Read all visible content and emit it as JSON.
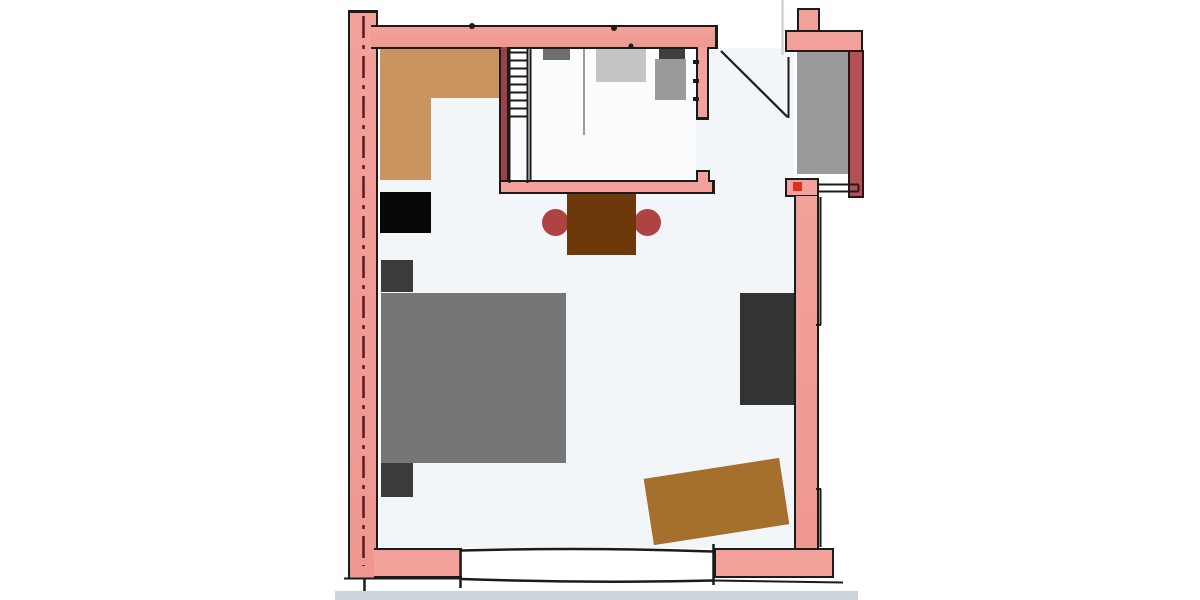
{
  "scene": {
    "kind": "scanned hand-drawn floor plan sketch with colored furniture overlay blocks",
    "no_text_visible": true
  },
  "palette": {
    "outline": "#1b1b1b",
    "dash_maroon": "#5b1a22",
    "wall_pink": "#f2a29b",
    "wall_pink_deep": "#ee978f",
    "wall_maroon": "#9c4149",
    "wall_deepred": "#b25156",
    "wall_deepred_edge": "#331116",
    "floor_main": "#f2f6f9",
    "floor_closet": "#fafcfe",
    "page_edge": "#ccd4da",
    "closet_tan": "#c9945f",
    "shelf_gray": "#6f6f6f",
    "shelf_light": "#c5c5c5",
    "shelf_dark": "#3f3f3f",
    "shelf_mid": "#9a9a9a",
    "divider_gray": "#9a9a9a",
    "black_unit": "#070707",
    "table_brown": "#6e390a",
    "chair_red": "#ad4343",
    "nightstand_gray": "#3b3b3b",
    "bed_gray": "#767676",
    "wardrobe_charcoal": "#333333",
    "rug_brown": "#a56f2d",
    "niche_gray": "#9a9a9a",
    "red_dot": "#e2301e",
    "fold_line": "#d9d3c7"
  },
  "items": [
    {
      "id": "closet-tan",
      "desc": "L-shaped tan wardrobe/closet block, top-left corner of room"
    },
    {
      "id": "ladder-stairs",
      "desc": "ladder/stair shaft with 9 rungs beside closet"
    },
    {
      "id": "shelf-units",
      "desc": "four gray storage blocks along top inner room"
    },
    {
      "id": "black-box",
      "desc": "black unit against left wall"
    },
    {
      "id": "dining-table",
      "desc": "brown square table with two dark-red round chairs"
    },
    {
      "id": "bed",
      "desc": "large gray double bed with two dark nightstands"
    },
    {
      "id": "wardrobe",
      "desc": "charcoal wardrobe against right wall"
    },
    {
      "id": "rug",
      "desc": "tilted brown rug, bottom right"
    },
    {
      "id": "entry-door",
      "desc": "door swing line at top-right opening"
    },
    {
      "id": "niche",
      "desc": "gray niche/entry mat recess at upper right"
    }
  ]
}
